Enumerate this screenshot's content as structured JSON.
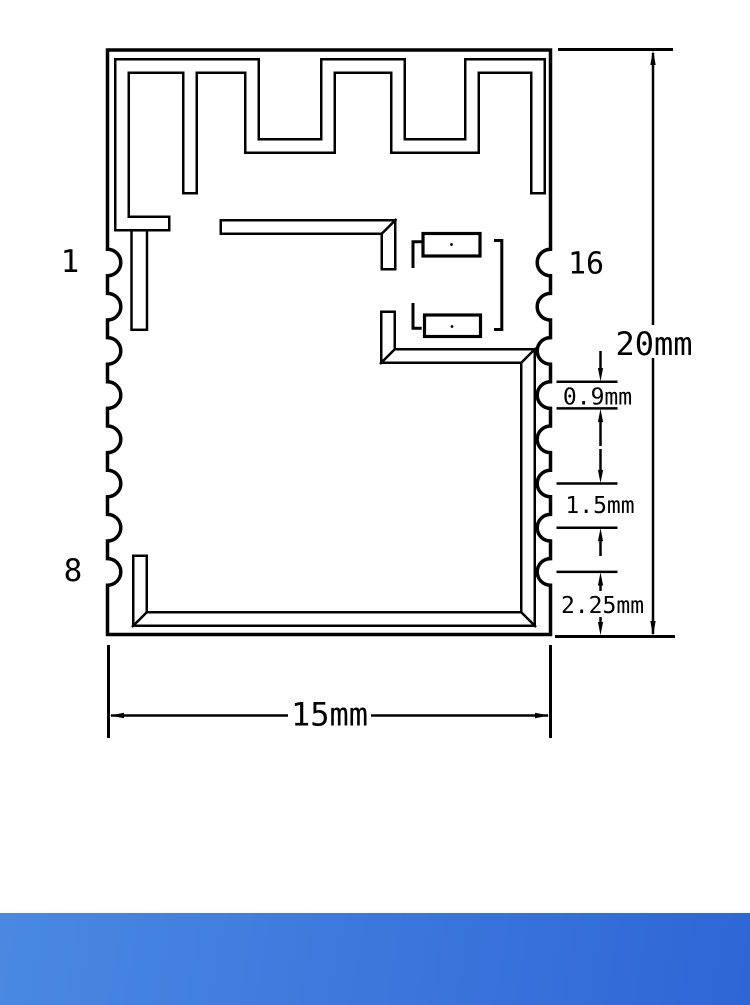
{
  "drawing": {
    "description": "Mechanical dimension drawing of a 15mm x 20mm castellated RF module with meander PCB antenna",
    "pins": {
      "left_top": "1",
      "left_bottom": "8",
      "right_top": "16"
    },
    "dimensions": {
      "overall_height": "20mm",
      "pad_width": "0.9mm",
      "pad_pitch": "1.5mm",
      "bottom_pad_offset": "2.25mm",
      "overall_width": "15mm"
    },
    "colors": {
      "ink": "#000000",
      "canvas": "#ffffff",
      "footer_gradient_start": "#4A89E2",
      "footer_gradient_end": "#2E66D6"
    }
  }
}
